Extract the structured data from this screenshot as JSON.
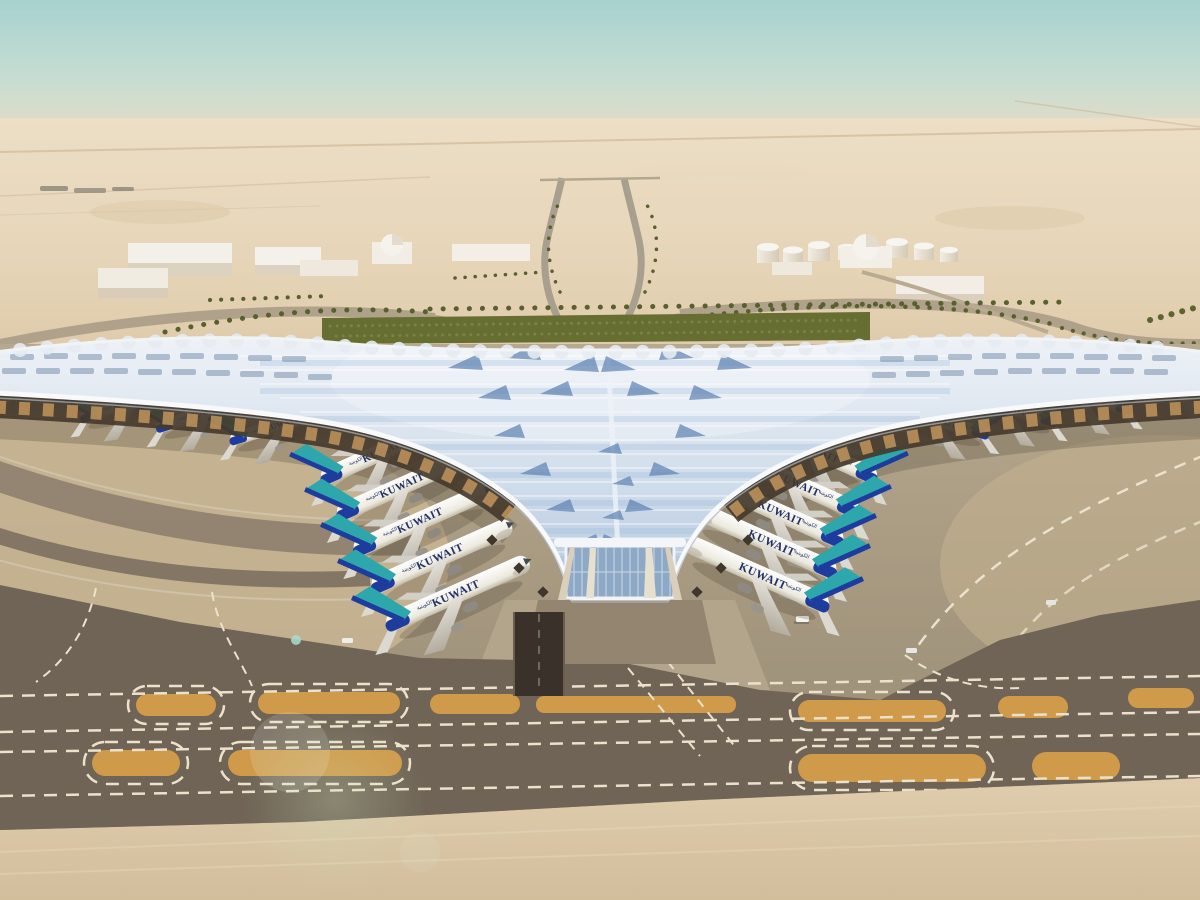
{
  "image": {
    "title": "Kuwait International Airport new terminal — aerial architectural rendering",
    "description": "Trefoil airport terminal with sweeping blue-white skylight roof, rows of Kuwait Airways widebody jets at two concourse faces, desert landside with palm-lined roads, support buildings and fuel tank farm, taxiway band with orange unpaved islands in foreground."
  },
  "airline": {
    "name": "KUWAIT",
    "name_arabic": "الكويتية",
    "fuselage_color": "#f6f4ef",
    "tail_color": "#2ea7ac",
    "tail_stripe_color": "#1d3c9e",
    "wordmark_color": "#233066"
  },
  "aircraft": {
    "total_visible": 18,
    "left_column_count": 5,
    "right_column_count": 5,
    "left_wing_count": 4,
    "right_wing_count": 4,
    "instances": [
      {
        "proto": "R",
        "x": 386,
        "y": 450,
        "rot": -24,
        "scale": 0.95
      },
      {
        "proto": "R",
        "x": 404,
        "y": 485,
        "rot": -24,
        "scale": 0.98
      },
      {
        "proto": "R",
        "x": 422,
        "y": 520,
        "rot": -24,
        "scale": 1.0
      },
      {
        "proto": "R",
        "x": 442,
        "y": 556,
        "rot": -24,
        "scale": 1.03
      },
      {
        "proto": "R",
        "x": 458,
        "y": 593,
        "rot": -24,
        "scale": 1.05
      },
      {
        "proto": "L",
        "x": 812,
        "y": 449,
        "rot": 24,
        "scale": 0.95
      },
      {
        "proto": "L",
        "x": 792,
        "y": 482,
        "rot": 24,
        "scale": 0.98
      },
      {
        "proto": "L",
        "x": 775,
        "y": 511,
        "rot": 24,
        "scale": 1.0
      },
      {
        "proto": "L",
        "x": 766,
        "y": 541,
        "rot": 24,
        "scale": 1.03
      },
      {
        "proto": "L",
        "x": 757,
        "y": 574,
        "rot": 24,
        "scale": 1.05
      },
      {
        "proto": "R",
        "x": 132,
        "y": 402,
        "rot": -17,
        "scale": 0.72
      },
      {
        "proto": "R",
        "x": 208,
        "y": 412,
        "rot": -17,
        "scale": 0.72
      },
      {
        "proto": "R",
        "x": 283,
        "y": 424,
        "rot": -17,
        "scale": 0.74
      },
      {
        "proto": "R",
        "x": 16,
        "y": 380,
        "rot": -17,
        "scale": 0.7
      },
      {
        "proto": "L",
        "x": 1005,
        "y": 408,
        "rot": 15,
        "scale": 0.72
      },
      {
        "proto": "L",
        "x": 1080,
        "y": 396,
        "rot": 15,
        "scale": 0.72
      },
      {
        "proto": "L",
        "x": 935,
        "y": 420,
        "rot": 15,
        "scale": 0.74
      },
      {
        "proto": "L",
        "x": 1175,
        "y": 382,
        "rot": 15,
        "scale": 0.7
      }
    ]
  },
  "terminal": {
    "roof_light": "#eef2f7",
    "roof_blue": "#9db9da",
    "roof_deep_blue": "#5b80b0",
    "fascia_white": "#f8f9fb",
    "under_canopy_shadow": "#443a2d",
    "canopy_glow": "#c89a5f",
    "facade_glass": "#8ea9c6"
  },
  "environment": {
    "sky_top": "#a7d2cf",
    "sky_horizon_haze": "#e9dcc4",
    "desert_light": "#ecdfc6",
    "desert_dark": "#dfcbab",
    "hedge_green": "#676e31",
    "palm_green": "#57602e",
    "road_gray": "#b0a28a",
    "buildings_left_count": 6,
    "dome_buildings_count": 2,
    "fuel_tanks_count": 8
  },
  "ground": {
    "apron_light": "#b7a98f",
    "apron_dark": "#9f927a",
    "taxiway_band": "#6f6456",
    "unpaved_island_orange": "#cf9a49",
    "marking_white": "#ece2cc",
    "bottom_pavement_sand": "#dbc8a8",
    "island_rows": 2,
    "islands_row_a_count": 7,
    "islands_row_b_count": 4
  }
}
